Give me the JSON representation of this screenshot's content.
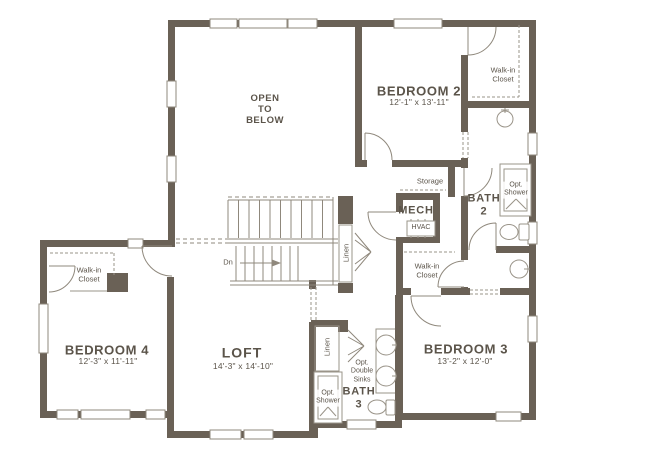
{
  "colors": {
    "wall": "#6a6156",
    "line": "#8f887c",
    "fixture": "#9a9489",
    "text": "#5b544a"
  },
  "rooms": {
    "open_to_below": "OPEN\nTO\nBELOW",
    "bedroom2": {
      "name": "BEDROOM 2",
      "dims": "12'-1\" x 13'-11\""
    },
    "bedroom3": {
      "name": "BEDROOM 3",
      "dims": "13'-2\" x 12'-0\""
    },
    "bedroom4": {
      "name": "BEDROOM 4",
      "dims": "12'-3\" x 11'-11\""
    },
    "loft": {
      "name": "LOFT",
      "dims": "14'-3\" x 14'-10\""
    },
    "bath2": "BATH\n2",
    "bath3": "BATH\n3",
    "mech": "MECH"
  },
  "closets": {
    "walkin_top_right": "Walk-in\nCloset",
    "walkin_mid_right": "Walk-in\nCloset",
    "walkin_left": "Walk-in\nCloset",
    "linen_stairs": "Linen",
    "linen_bath3": "Linen",
    "storage": "Storage"
  },
  "features": {
    "hvac": "HVAC",
    "opt_shower_bath2": "Opt.\nShower",
    "opt_shower_bath3": "Opt.\nShower",
    "opt_double_sinks": "Opt.\nDouble\nSinks",
    "stairs_down": "Dn"
  }
}
